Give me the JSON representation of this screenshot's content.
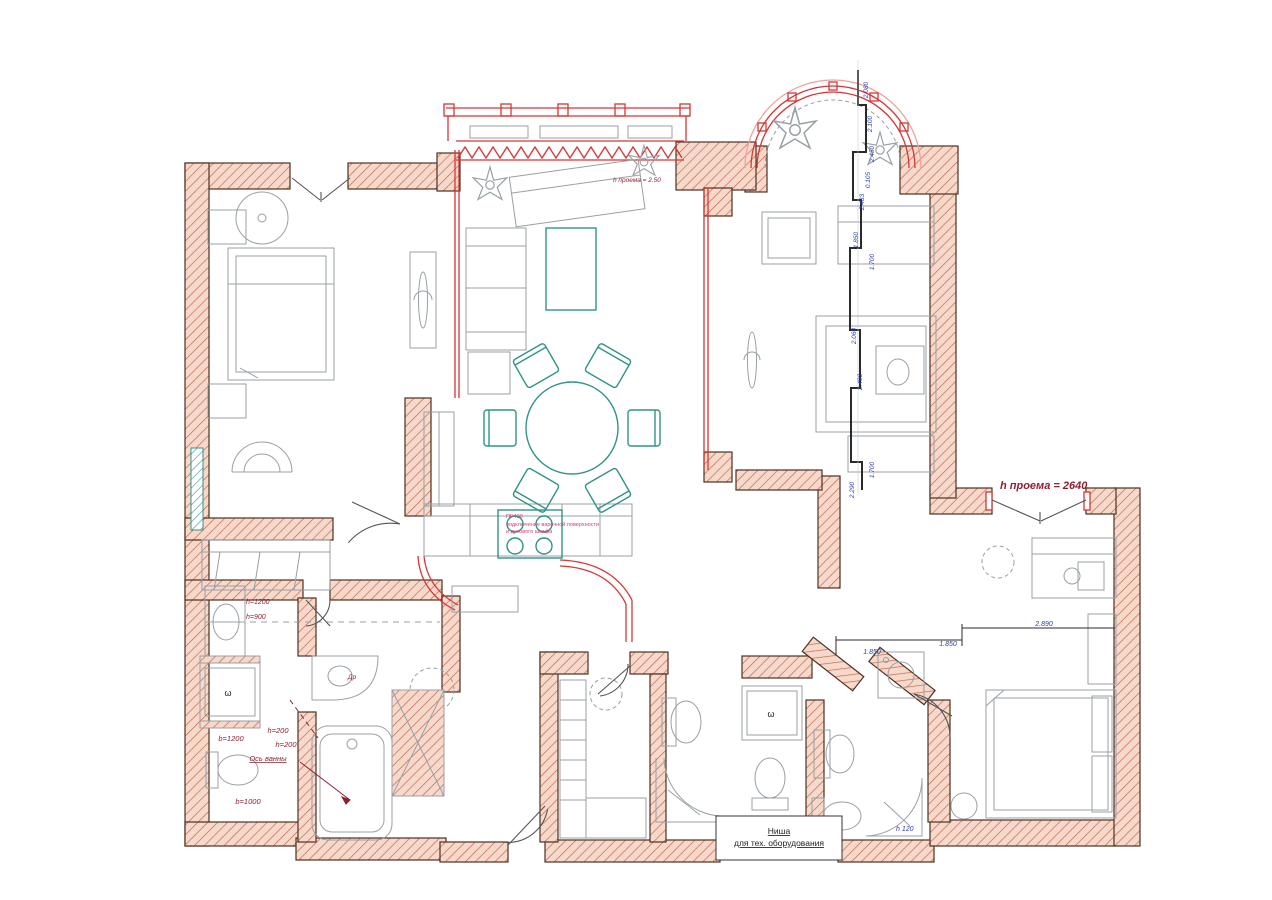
{
  "page": {
    "background": "#ffffff",
    "type": "architectural floor plan"
  },
  "colors": {
    "wall_fill": "#f7d9cc",
    "wall_hatch": "#c4684e",
    "wall_stroke": "#4a3222",
    "red_accent": "#d93434",
    "dark_red_text": "#8e2030",
    "pink_note": "#d04070",
    "blue_dimension": "#2b3eae",
    "teal_furniture": "#2f9486",
    "gray_furniture": "#98a0a6"
  },
  "labels": {
    "opening_height": "h проема = 2640",
    "opening_height_small": "h проема = 2.50",
    "niche_line1": "Ниша",
    "niche_line2": "для тех. оборудования",
    "bath_axis": "Ось ванны",
    "shower_width": "b=1200",
    "ledge_height_1": "h=200",
    "ledge_height_2": "h=200",
    "bath_width": "b=1000",
    "mirror_height_1": "h=1200",
    "mirror_height_2": "h=900",
    "door_abbr": "Др",
    "cooktop_note_code": "ПР430",
    "cooktop_note_line1": "подключение варочной поверхности",
    "cooktop_note_line2": "и духового шкафа",
    "shower_step_height": "h 120",
    "drain_symbol": "ω"
  },
  "dimensions": {
    "vertical": {
      "v1": "2.080",
      "v2": "2.100",
      "v3": "2.450",
      "v4": "0.105",
      "v5": "2.483",
      "v6": "1.850",
      "v7": "1.700",
      "v8": "2.060",
      "v9": "2.493",
      "v10": "1.700",
      "v11": "2.290"
    },
    "horizontal": {
      "h1": "1.850",
      "h2": "1.850",
      "h3": "2.890"
    }
  }
}
